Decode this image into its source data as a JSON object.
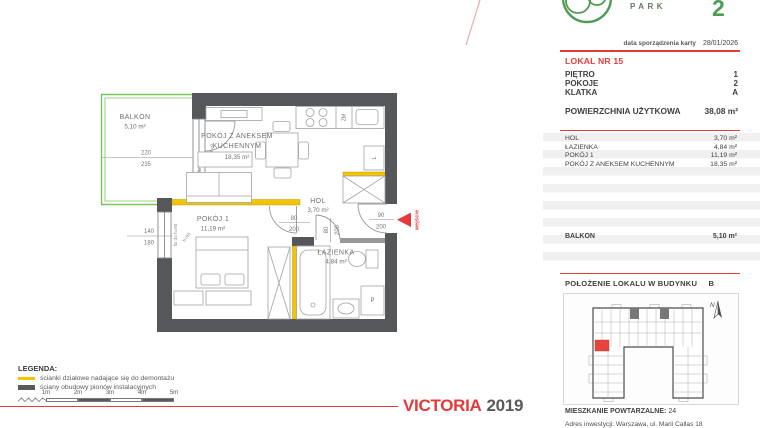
{
  "brand": {
    "park_label": "PARK",
    "building_number": "2",
    "victoria": "VICTORIA",
    "year": "2019"
  },
  "card": {
    "date_label": "data sporządzenia karty",
    "date_value": "28/01/2026",
    "unit_title": "LOKAL NR 15",
    "info_rows": [
      {
        "label": "PIĘTRO",
        "value": "1"
      },
      {
        "label": "POKOJE",
        "value": "2"
      },
      {
        "label": "KLATKA",
        "value": "A"
      }
    ],
    "area_label": "POWIERZCHNIA UŻYTKOWA",
    "area_value": "38,08 m²",
    "rooms": [
      {
        "name": "HOL",
        "area": "3,70 m²"
      },
      {
        "name": "ŁAZIENKA",
        "area": "4,84 m²"
      },
      {
        "name": "POKÓJ 1",
        "area": "11,19 m²"
      },
      {
        "name": "POKÓJ Z ANEKSEM KUCHENNYM",
        "area": "18,35 m²"
      }
    ],
    "balcony_row": {
      "name": "BALKON",
      "area": "5,10 m²"
    },
    "location_label": "POŁOŻENIE LOKALU W BUDYNKU",
    "location_value": "B",
    "north_label": "N",
    "repeat_label": "MIESZKANIE POWTARZALNE:",
    "repeat_value": "24",
    "address": "Adres inwestycji: Warszawa, ul. Marii Callas 18"
  },
  "plan": {
    "balcony": {
      "name": "BALKON",
      "area": "5,10 m²",
      "dim_width": "220",
      "dim_height": "235"
    },
    "living": {
      "name_line1": "POKÓJ Z ANEKSEM",
      "name_line2": "KUCHENNYM",
      "area": "18,35 m²"
    },
    "hall": {
      "name": "HOL",
      "area": "3,70 m²"
    },
    "bedroom": {
      "name": "POKÓJ 1",
      "area": "11,19 m²"
    },
    "bathroom": {
      "name": "ŁAZIENKA",
      "area": "4,84 m²"
    },
    "dims": {
      "bedroom_door_w": "80",
      "bedroom_door_h": "200",
      "bath_door_w": "80",
      "bath_door_h": "200",
      "entry_door_w": "90",
      "entry_door_h": "200",
      "window_w": "140",
      "window_h": "180",
      "window_note": "fix do h=90",
      "window_note2": "h=95",
      "balcony_door_note": "fix",
      "balcony_door_note2": "h=0"
    },
    "entry_label": "wejście",
    "appliances": {
      "dishwasher": "ZM",
      "fridge": "L",
      "washer": "P"
    }
  },
  "legend": {
    "title": "LEGENDA:",
    "items": [
      {
        "label": "ścianki działowe nadające się do demontażu"
      },
      {
        "label": "ściany obudowy pionów instalacyjnych"
      }
    ],
    "scale_labels": [
      "1m",
      "2m",
      "3m",
      "4m",
      "5m"
    ]
  },
  "colors": {
    "accent_red": "#e23b39",
    "brand_green": "#4f9c55",
    "balcony_green": "#7cc35c",
    "demountable_yellow": "#f3c402",
    "wall_gray": "#56575b",
    "text_dark": "#414042",
    "text_gray": "#58595b"
  }
}
